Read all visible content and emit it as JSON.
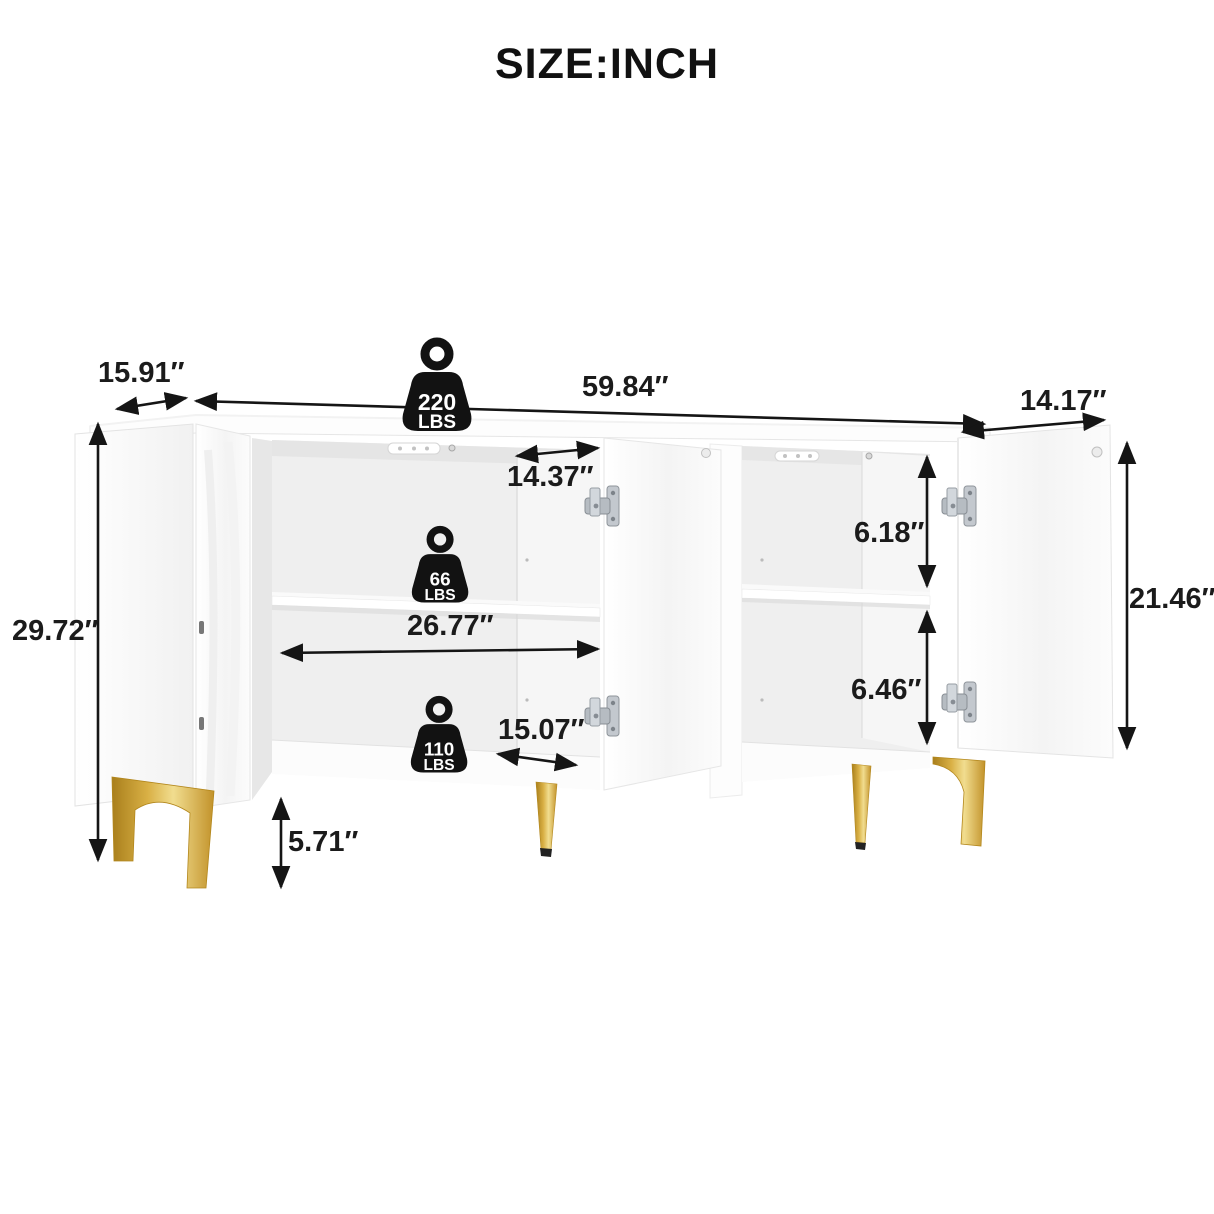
{
  "title": "SIZE:INCH",
  "dimensions": {
    "top_depth": "15.91″",
    "overall_width": "59.84″",
    "right_door_width": "14.17″",
    "overall_height": "29.72″",
    "left_door_width": "14.37″",
    "interior_width": "26.77″",
    "bottom_opening_width": "15.07″",
    "upper_compartment_height": "6.18″",
    "lower_compartment_height": "6.46″",
    "door_height": "21.46″",
    "leg_height": "5.71″"
  },
  "weights": {
    "top": {
      "value": "220",
      "unit": "LBS"
    },
    "shelf": {
      "value": "66",
      "unit": "LBS"
    },
    "bottom": {
      "value": "110",
      "unit": "LBS"
    }
  },
  "colors": {
    "dimension_line": "#151515",
    "badge_black": "#121212",
    "gold_leg": "#C9A12E",
    "cabinet_white": "#FDFDFD",
    "interior_gray": "#EFEFEF",
    "hinge_silver": "#B9BFC6"
  }
}
